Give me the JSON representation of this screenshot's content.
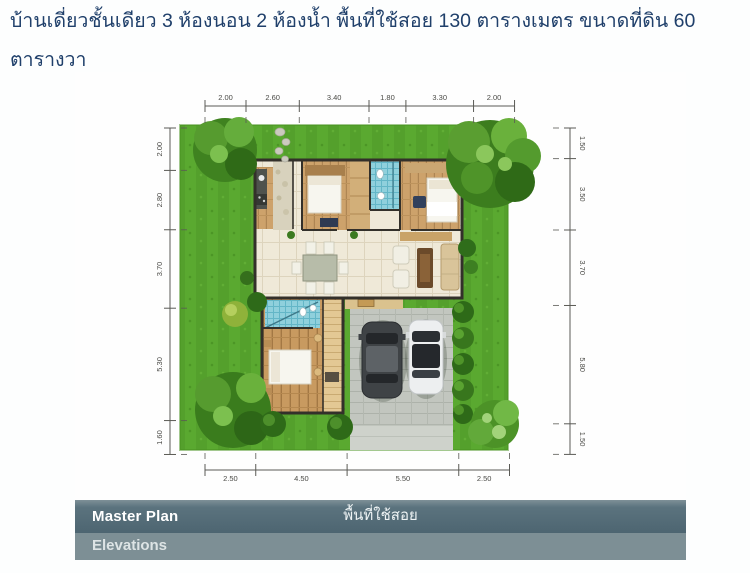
{
  "header": {
    "text": "บ้านเดี่ยวชั้นเดียว 3 ห้องนอน 2 ห้องน้ำ พื้นที่ใช้สอย 130 ตารางเมตร ขนาดที่ดิน 60 ตารางวา"
  },
  "plan": {
    "dimensions": {
      "top": [
        "2.00",
        "2.60",
        "3.40",
        "1.80",
        "3.30",
        "2.00"
      ],
      "bottom": [
        "2.50",
        "4.50",
        "5.50",
        "2.50"
      ],
      "left": [
        "2.00",
        "2.80",
        "3.70",
        "5.30",
        "1.60"
      ],
      "right": [
        "1.50",
        "3.50",
        "3.70",
        "5.80",
        "1.50"
      ]
    },
    "features": [
      "lawn",
      "house",
      "carport-two-cars",
      "trees",
      "shrub-row"
    ]
  },
  "tabs": {
    "master_plan_label": "Master Plan",
    "master_plan_caption": "พื้นที่ใช้สอย",
    "elevations_label": "Elevations"
  },
  "colors": {
    "heading_text": "#20406b",
    "tab_dark": "#4d6571",
    "tab_light": "#7d8f95",
    "grass": "#54a02c",
    "floor_tile": "#efe9d8",
    "wood_floor": "#cda26b",
    "bath_tile": "#8fd0dc",
    "driveway": "#c2c6bf"
  }
}
